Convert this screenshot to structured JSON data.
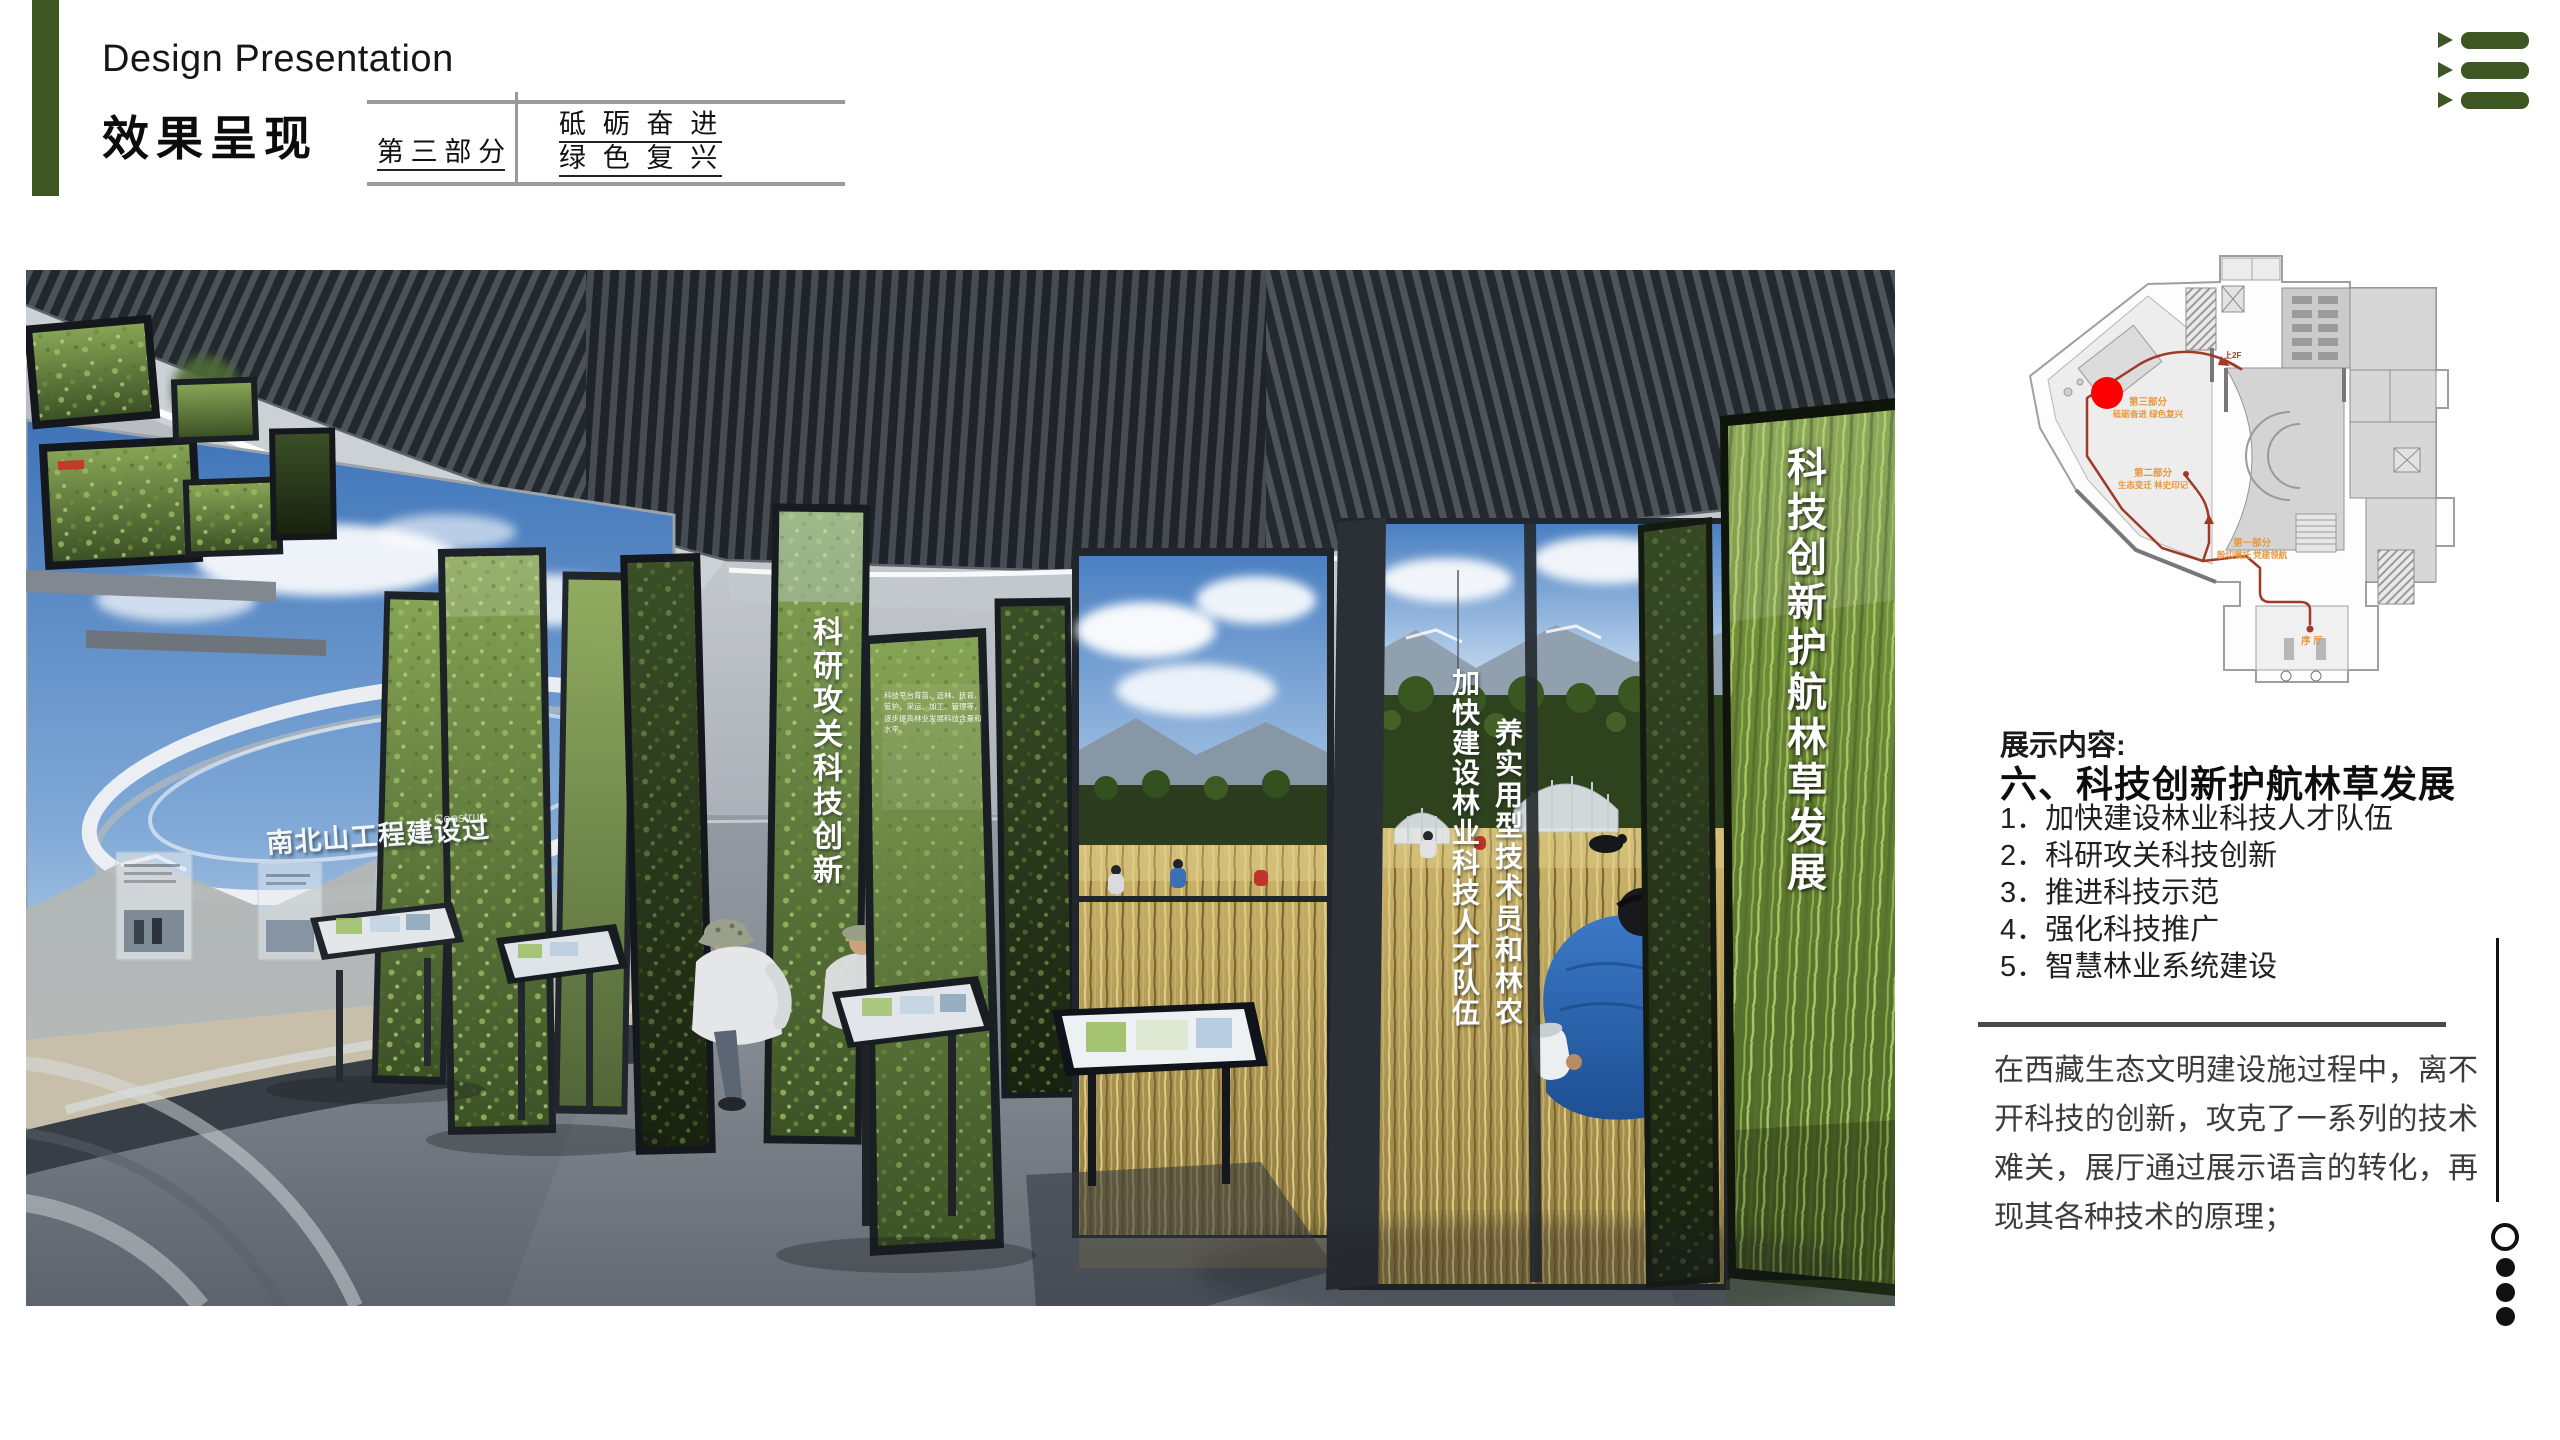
{
  "header": {
    "title_en": "Design Presentation",
    "title_zh": "效果呈现",
    "stamp": {
      "part_label": "第 三 部 分",
      "slogan_line1": "砥 砺 奋 进",
      "slogan_line2": "绿 色 复 兴"
    }
  },
  "nav_icon": {
    "name": "list-menu-icon",
    "color": "#3e5722"
  },
  "floor_plan": {
    "marker_color": "#ff0000",
    "route_color": "#9e3b27",
    "label_color": "#e9973b",
    "labels": {
      "part3_title": "第三部分",
      "part3_sub": "砥砺奋进 绿色复兴",
      "part2_title": "第二部分",
      "part2_sub": "生态变迁 林史印记",
      "part1_title": "第一部分",
      "part1_sub": "殷切嘱托 党建领航",
      "lobby": "序 厅",
      "upstairs": "上2F"
    }
  },
  "content": {
    "heading": "展示内容:",
    "section_title": "六、科技创新护航林草发展",
    "items": [
      "1．加快建设林业科技人才队伍",
      "2．科研攻关科技创新",
      "3．推进科技示范",
      "4．强化科技推广",
      "5．智慧林业系统建设"
    ],
    "paragraph": "在西藏生态文明建设施过程中，离不开科技的创新，攻克了一系列的技术难关，展厅通过展示语言的转化，再现其各种技术的原理；"
  },
  "render": {
    "banner_right": "科技创新护航林草发展",
    "banner_keyan": "科研攻关科技创新",
    "banner_jiakuai": "加快建设林业科技人才队伍",
    "banner_yang": "养实用型技术员和林农",
    "screen_title": "南北山工程建设过",
    "screen_subtitle": "Construc",
    "panel_note": "科技平台育苗、造林、抚育、管护、采运、加工、管理等，逐步提高林业发展科技含量和水平。"
  },
  "pagination": {
    "active_index": 0,
    "count": 4
  }
}
